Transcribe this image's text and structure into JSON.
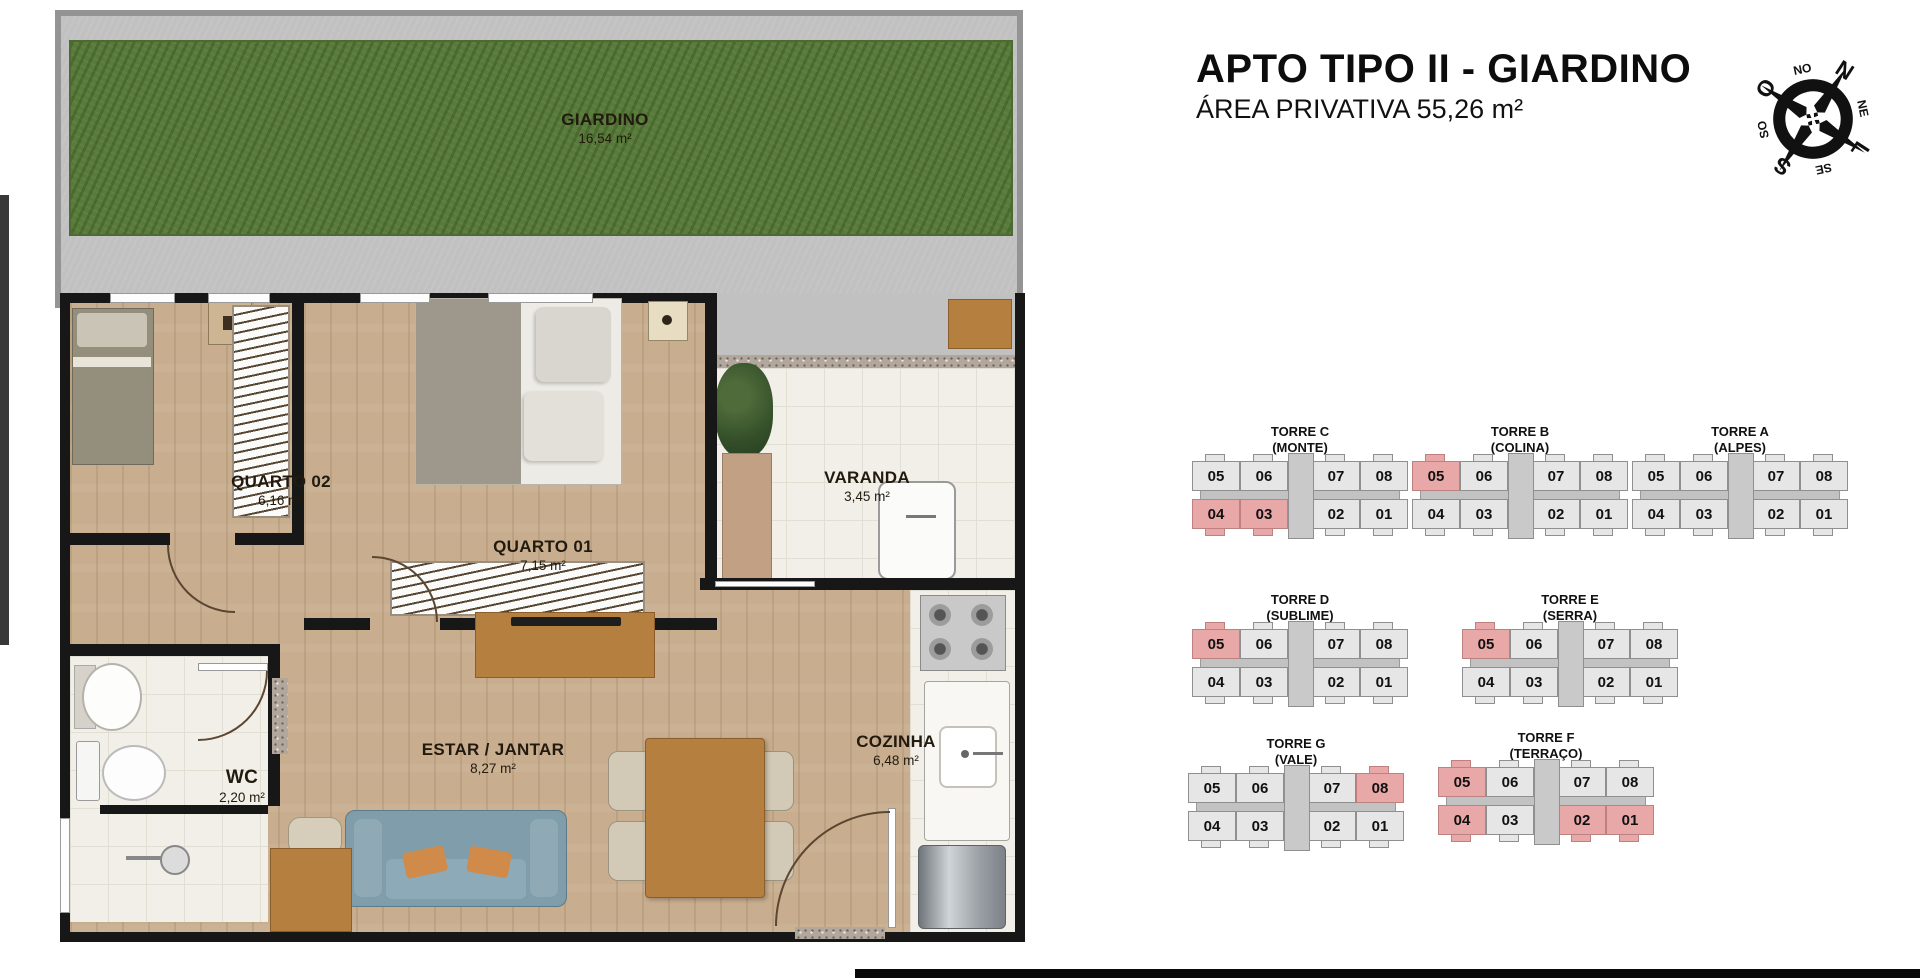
{
  "header": {
    "title": "APTO TIPO II - GIARDINO",
    "subtitle": "ÁREA PRIVATIVA 55,26 m²"
  },
  "compass": {
    "n": "N",
    "ne": "NE",
    "l": "L",
    "se": "SE",
    "s": "S",
    "so": "SO",
    "o": "O",
    "no": "NO"
  },
  "floorplan": {
    "rooms": {
      "giardino": {
        "name": "GIARDINO",
        "area": "16,54 m²"
      },
      "quarto02": {
        "name": "QUARTO 02",
        "area": "6,16 m²"
      },
      "quarto01": {
        "name": "QUARTO 01",
        "area": "7,15 m²"
      },
      "varanda": {
        "name": "VARANDA",
        "area": "3,45 m²"
      },
      "estar_jantar": {
        "name": "ESTAR / JANTAR",
        "area": "8,27 m²"
      },
      "cozinha": {
        "name": "COZINHA",
        "area": "6,48 m²"
      },
      "wc": {
        "name": "WC",
        "area": "2,20 m²"
      }
    }
  },
  "towers": [
    {
      "name": "TORRE C",
      "subname": "(MONTE)",
      "top_units": [
        "05",
        "06",
        "07",
        "08"
      ],
      "bottom_units": [
        "04",
        "03",
        "02",
        "01"
      ],
      "highlighted": [
        "04",
        "03"
      ]
    },
    {
      "name": "TORRE B",
      "subname": "(COLINA)",
      "top_units": [
        "05",
        "06",
        "07",
        "08"
      ],
      "bottom_units": [
        "04",
        "03",
        "02",
        "01"
      ],
      "highlighted": [
        "05"
      ]
    },
    {
      "name": "TORRE A",
      "subname": "(ALPES)",
      "top_units": [
        "05",
        "06",
        "07",
        "08"
      ],
      "bottom_units": [
        "04",
        "03",
        "02",
        "01"
      ],
      "highlighted": []
    },
    {
      "name": "TORRE D",
      "subname": "(SUBLIME)",
      "top_units": [
        "05",
        "06",
        "07",
        "08"
      ],
      "bottom_units": [
        "04",
        "03",
        "02",
        "01"
      ],
      "highlighted": [
        "05"
      ]
    },
    {
      "name": "TORRE E",
      "subname": "(SERRA)",
      "top_units": [
        "05",
        "06",
        "07",
        "08"
      ],
      "bottom_units": [
        "04",
        "03",
        "02",
        "01"
      ],
      "highlighted": [
        "05"
      ]
    },
    {
      "name": "TORRE G",
      "subname": "(VALE)",
      "top_units": [
        "05",
        "06",
        "07",
        "08"
      ],
      "bottom_units": [
        "04",
        "03",
        "02",
        "01"
      ],
      "highlighted": [
        "08"
      ]
    },
    {
      "name": "TORRE F",
      "subname": "(TERRAÇO)",
      "top_units": [
        "05",
        "06",
        "07",
        "08"
      ],
      "bottom_units": [
        "04",
        "03",
        "02",
        "01"
      ],
      "highlighted": [
        "05",
        "04",
        "02",
        "01"
      ]
    }
  ],
  "colors": {
    "highlight_unit": "#e9a8a8",
    "normal_unit": "#e6e6e6",
    "unit_border": "#8f8f8f",
    "garden_green": "#587a3a",
    "concrete_gray": "#c1c1c1",
    "wall_black": "#171717",
    "wood_floor": "#c8ae8e",
    "tile_white": "#f2efe8",
    "sofa_blue": "#7f9dab",
    "pillow_orange": "#d08a4a"
  }
}
